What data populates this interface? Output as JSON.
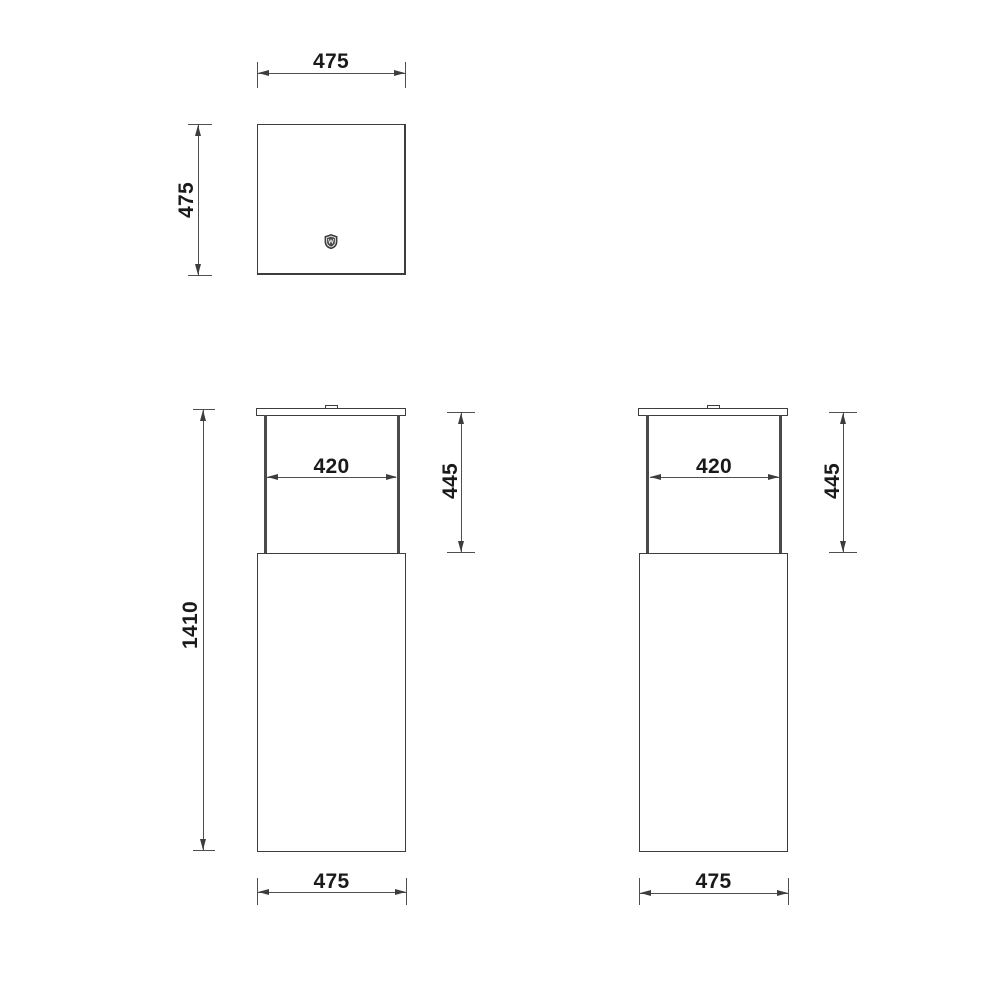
{
  "drawing": {
    "description": "Dimensioned technical drawing of a square pedestal column with an open glass top section and lid, shown in top view and two elevation views",
    "colors": {
      "background": "#ffffff",
      "object_line": "#3d3d3d",
      "dimension_line": "#4f4f4f",
      "text": "#1a1a1a",
      "post": "#4a4a4a"
    },
    "icons": {
      "brand_logo": "shield-crest-icon"
    },
    "top_view": {
      "width": "475",
      "depth": "475"
    },
    "front_view": {
      "opening_width": "420",
      "glass_height": "445",
      "total_height": "1410",
      "base_width": "475"
    },
    "side_view": {
      "opening_width": "420",
      "glass_height": "445",
      "base_width": "475"
    }
  }
}
